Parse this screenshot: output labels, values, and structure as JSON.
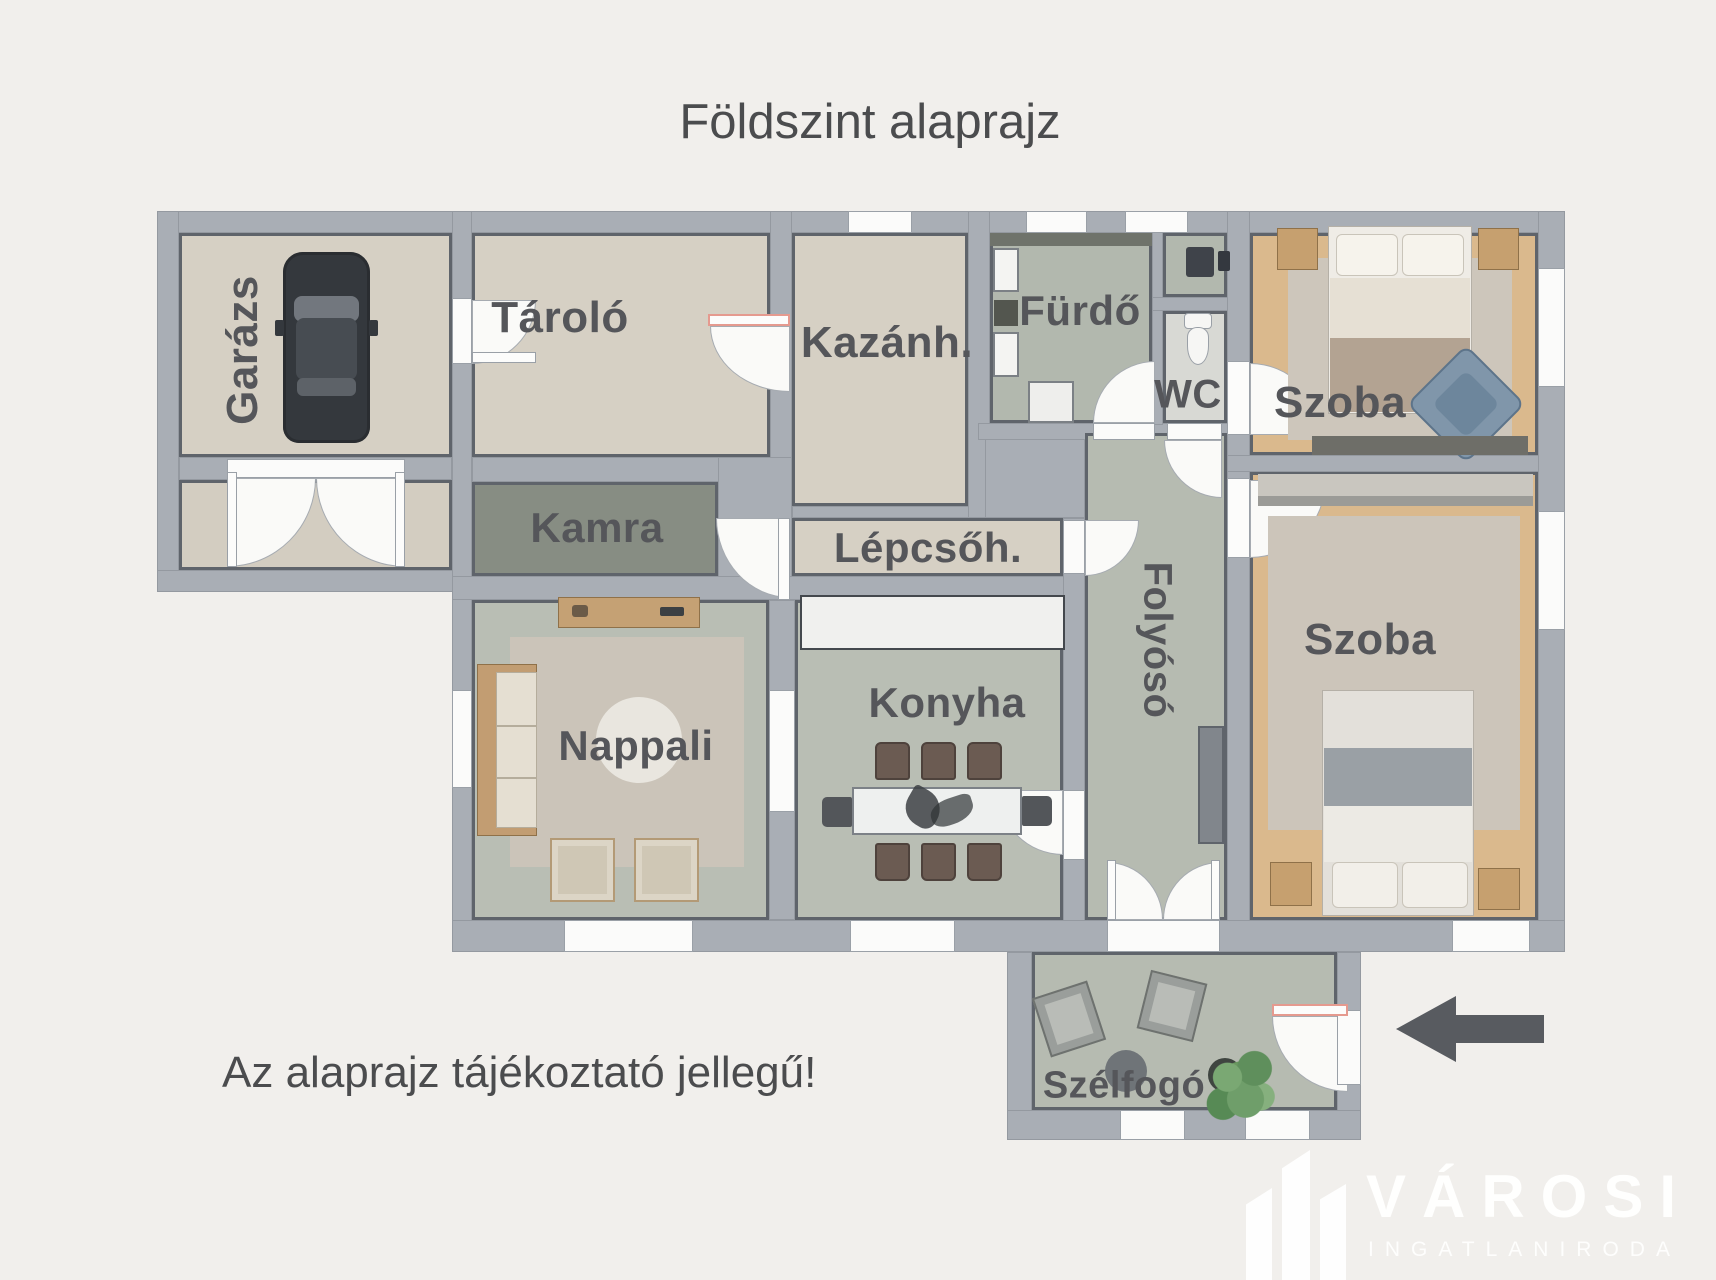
{
  "title": "Földszint alaprajz",
  "disclaimer": "Az alaprajz tájékoztató jellegű!",
  "rooms": {
    "garazs": {
      "label": "Garázs"
    },
    "tarolo": {
      "label": "Tároló"
    },
    "kamra": {
      "label": "Kamra"
    },
    "kazanhaz": {
      "label": "Kazánh."
    },
    "lepcsohaz": {
      "label": "Lépcsőh."
    },
    "furdo": {
      "label": "Fürdő"
    },
    "wc": {
      "label": "WC"
    },
    "szoba_felso": {
      "label": "Szoba"
    },
    "szoba_also": {
      "label": "Szoba"
    },
    "folyoso": {
      "label": "Folyósó"
    },
    "nappali": {
      "label": "Nappali"
    },
    "konyha": {
      "label": "Konyha"
    },
    "szelfogo": {
      "label": "Szélfogó"
    }
  },
  "logo": {
    "brand": "VÁROSI",
    "subtitle": "INGATLANIRODA"
  },
  "palette": {
    "background": "#f1efec",
    "wall": "#a9aeb5",
    "floor_beige": "#d6d0c4",
    "floor_green_gray": "#b8bdb3",
    "floor_dark_green": "#878d83",
    "floor_wood": "#dab98d",
    "floor_wc": "#d8d9d4",
    "door_accent": "#e59a8f",
    "label_text": "#55565a",
    "arrow": "#585b60"
  }
}
